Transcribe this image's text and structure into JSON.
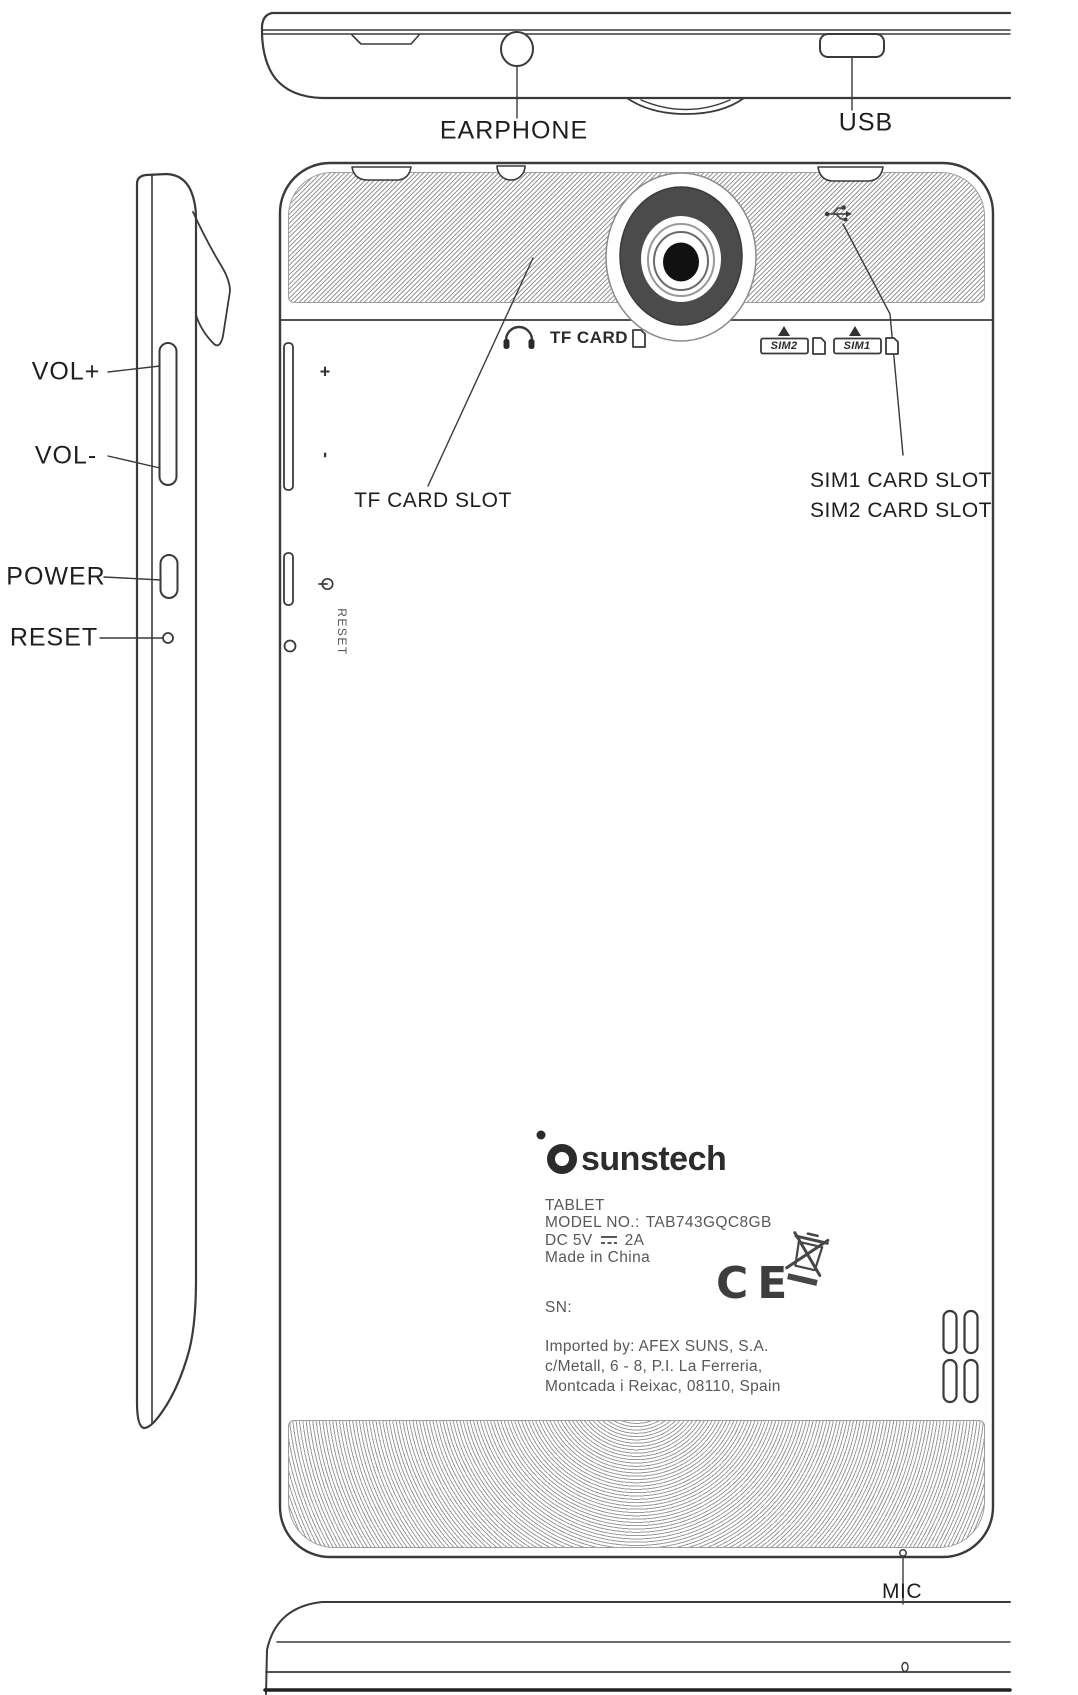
{
  "colors": {
    "line": "#3a3a3a",
    "camera_body": "#4b4b4b",
    "hatch": "#9a9a9a",
    "plate_text": "#585858",
    "label_text": "#1e1e1e",
    "brand_text": "#2c2c2c"
  },
  "top_view": {
    "earphone_label": "EARPHONE",
    "usb_label": "USB"
  },
  "side_view": {
    "vol_plus_label": "VOL+",
    "vol_minus_label": "VOL-",
    "power_label": "POWER",
    "reset_label": "RESET"
  },
  "back_view": {
    "tf_card_print": "TF CARD",
    "sim2_print": "SIM2",
    "sim1_print": "SIM1",
    "vol_plus_mark": "+",
    "vol_minus_mark": "-",
    "reset_print": "RESET",
    "tf_card_slot_label": "TF CARD SLOT",
    "sim1_card_slot_label": "SIM1 CARD SLOT",
    "sim2_card_slot_label": "SIM2 CARD SLOT",
    "mic_label": "MIC",
    "plate": {
      "brand": "sunstech",
      "product": "TABLET",
      "model_prefix": "MODEL NO.:",
      "model_no": "TAB743GQC8GB",
      "power_prefix": "DC 5V",
      "power_suffix": "2A",
      "origin": "Made in China",
      "serial": "SN:",
      "ce": "CE",
      "importer_line1": "Imported by: AFEX SUNS, S.A.",
      "importer_line2": "c/Metall, 6 - 8, P.I. La Ferreria,",
      "importer_line3": "Montcada i Reixac, 08110, Spain"
    }
  }
}
